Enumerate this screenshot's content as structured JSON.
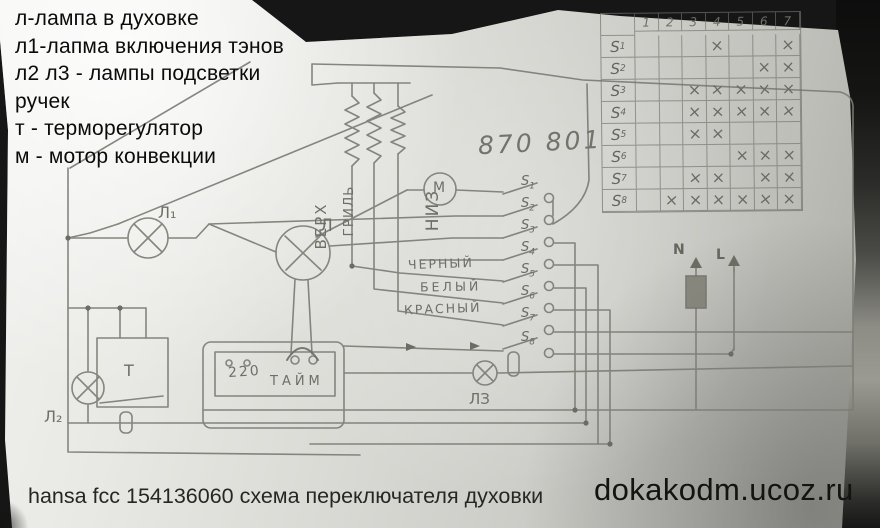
{
  "legend": {
    "lines": [
      "л-лампа в духовке",
      "л1-лапма включения тэнов",
      "л2 л3 - лампы подсветки",
      "ручек",
      "т - терморегулятор",
      "м - мотор конвекции"
    ]
  },
  "table": {
    "col_headers": [
      "1",
      "2",
      "3",
      "4",
      "5",
      "6",
      "7"
    ],
    "rows": [
      {
        "label": "S1",
        "marks": [
          4,
          7
        ]
      },
      {
        "label": "S2",
        "marks": [
          6,
          7
        ]
      },
      {
        "label": "S3",
        "marks": [
          3,
          4,
          5,
          6,
          7
        ]
      },
      {
        "label": "S4",
        "marks": [
          3,
          4,
          5,
          6,
          7
        ]
      },
      {
        "label": "S5",
        "marks": [
          3,
          4
        ]
      },
      {
        "label": "S6",
        "marks": [
          5,
          6,
          7
        ]
      },
      {
        "label": "S7",
        "marks": [
          3,
          4,
          6,
          7
        ]
      },
      {
        "label": "S8",
        "marks": [
          2,
          3,
          4,
          5,
          6,
          7
        ]
      }
    ],
    "mark_glyph": "×"
  },
  "schematic": {
    "part_number": "870 801",
    "heater_labels": {
      "top": "ВЕРХ",
      "grill": "ГРИЛЬ",
      "bottom": "НИЗ"
    },
    "motor_label": "М",
    "lamp_labels": {
      "oven": "Л",
      "l1": "Л₁",
      "l2": "Л₂",
      "l3": "ЛЗ"
    },
    "thermostat_label": "Т",
    "timer": {
      "voltage": "220",
      "label": "ТАЙМ"
    },
    "wire_labels": {
      "black": "ЧЕРНЫЙ",
      "white": "БЕЛЫЙ",
      "red": "КРАСНЫЙ"
    },
    "terminals": {
      "neutral": "N",
      "line": "L"
    },
    "switch_labels": [
      "S1",
      "S2",
      "S3",
      "S4",
      "S5",
      "S6",
      "S7",
      "S8"
    ]
  },
  "captions": {
    "bottom_left": "hansa fcc 154136060 схема переключателя духовки",
    "watermark": "dokakodm.ucoz.ru"
  },
  "colors": {
    "pencil": "#7d7d76",
    "ink": "#0b0b0b",
    "paper": "#dadad5"
  }
}
